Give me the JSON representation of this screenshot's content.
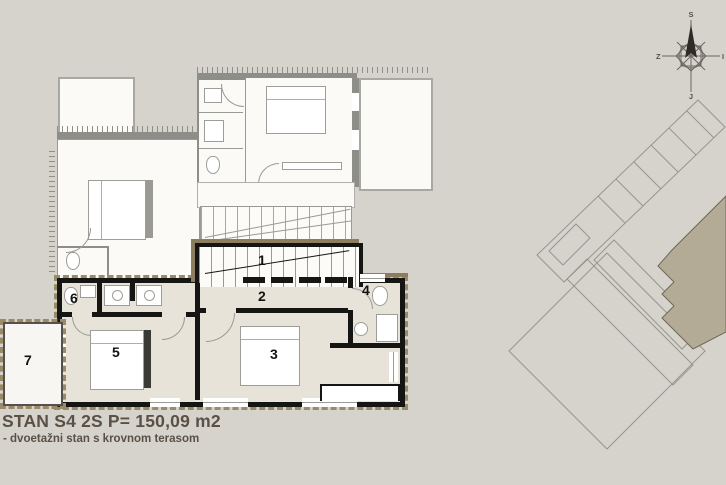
{
  "title": {
    "line1": "STAN S4 2S P= 150,09 m2",
    "line2": "- dvoetažni stan s krovnom terasom"
  },
  "floor_plan": {
    "room_labels": {
      "r1": "1",
      "r2": "2",
      "r3": "3",
      "r4": "4",
      "r5": "5",
      "r6": "6",
      "r7": "7"
    }
  },
  "compass": {
    "north": "S",
    "east": "I",
    "south": "J",
    "west": "Z"
  },
  "colors": {
    "background": "#d5d3cc",
    "current_floor_fill": "#e7e3d9",
    "current_floor_wall": "#151513",
    "outline_brown": "#8d7d60",
    "upper_floor_fill": "#fbfaf7",
    "upper_floor_wall": "#8e8e89",
    "highlight_unit_fill": "#b3ab96",
    "title_text": "#5a5045"
  }
}
